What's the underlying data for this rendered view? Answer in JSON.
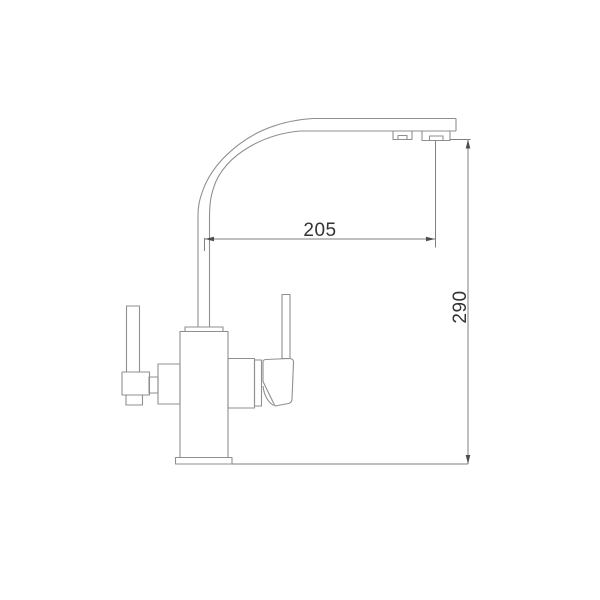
{
  "page": {
    "kind": "technical-line-drawing",
    "subject": "kitchen-faucet-side-view-with-dimensions"
  },
  "colors": {
    "background": "#ffffff",
    "outline": "#8f8f8f",
    "dimension_line": "#7f7f7f",
    "arrow": "#4c4c4c",
    "text": "#333333"
  },
  "dimensions": {
    "spout_reach": {
      "value": "205",
      "orientation": "horizontal"
    },
    "height": {
      "value": "290",
      "orientation": "vertical"
    }
  }
}
